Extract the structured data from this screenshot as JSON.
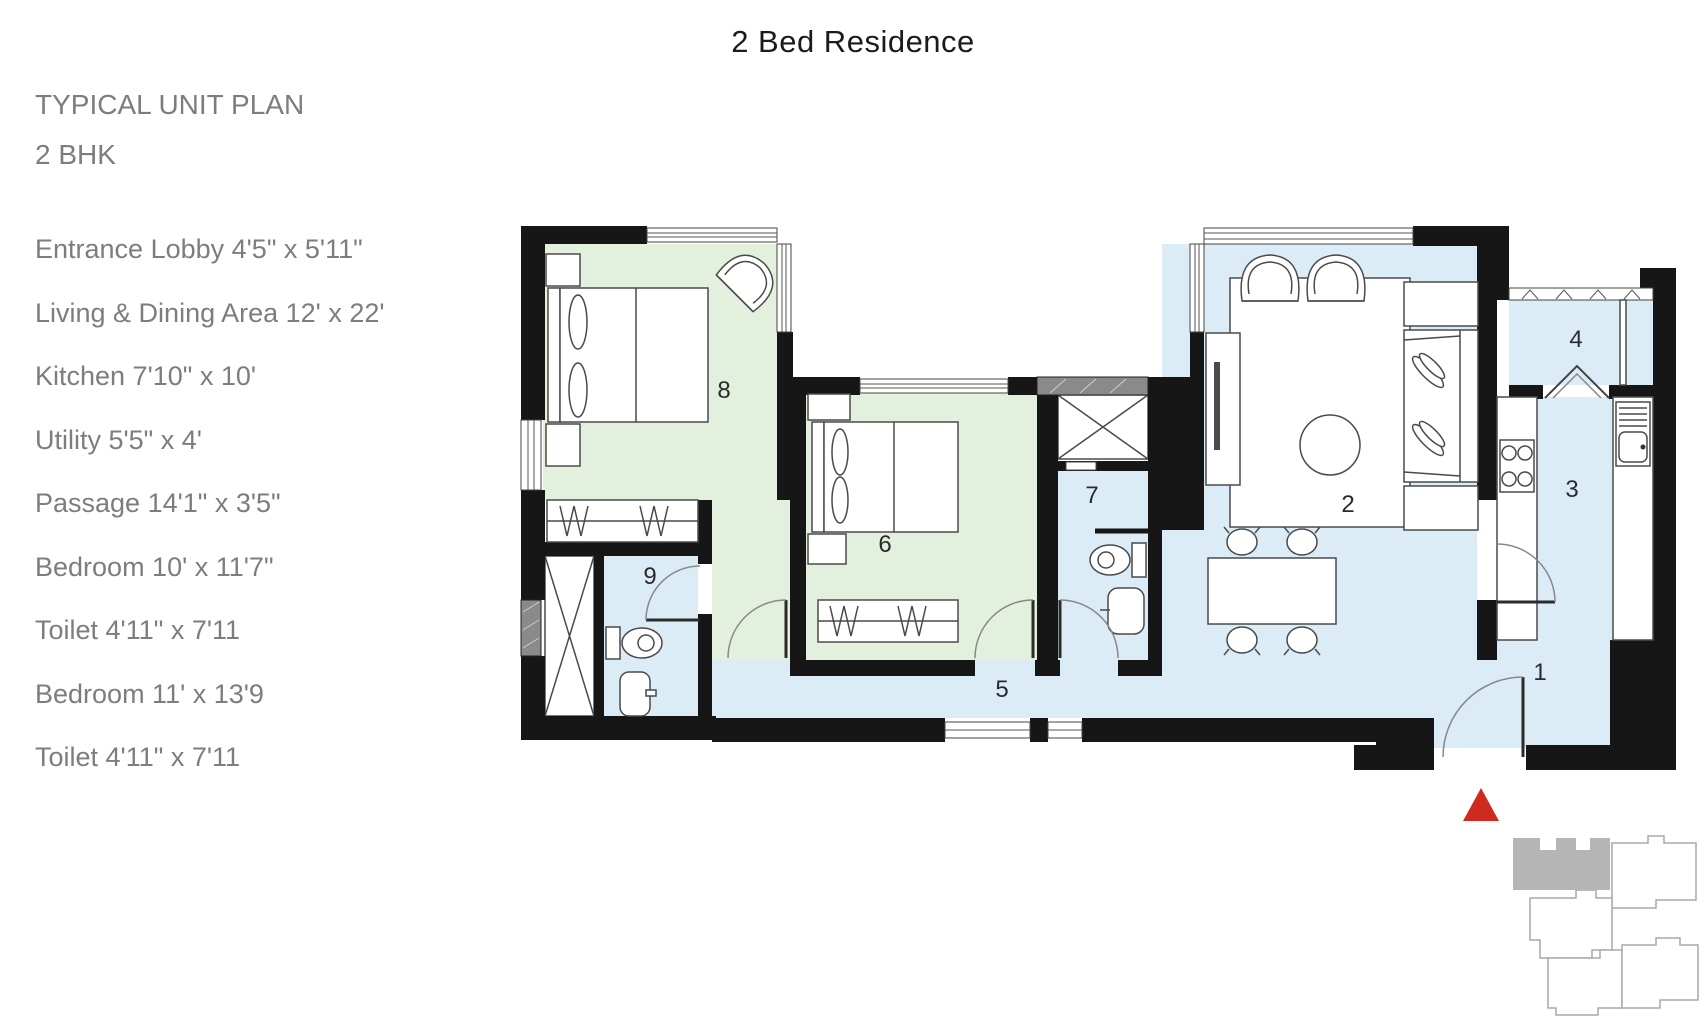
{
  "title": "2 Bed Residence",
  "heading": {
    "line1": "TYPICAL UNIT PLAN",
    "line2": "2 BHK"
  },
  "room_list": [
    "Entrance Lobby 4'5\" x 5'11\"",
    "Living & Dining Area 12' x 22'",
    "Kitchen 7'10\" x 10'",
    "Utility 5'5\" x 4'",
    "Passage 14'1\" x 3'5\"",
    "Bedroom 10' x 11'7\"",
    "Toilet 4'11\" x 7'11",
    "Bedroom 11' x 13'9",
    "Toilet 4'11\" x 7'11"
  ],
  "plan": {
    "room_numbers": {
      "entrance_lobby": "1",
      "living_dining": "2",
      "kitchen": "3",
      "utility": "4",
      "passage": "5",
      "bedroom_2": "6",
      "toilet_2": "7",
      "bedroom_1": "8",
      "toilet_1": "9"
    },
    "colors": {
      "bedroom_fill": "#e4f0de",
      "wet_area_fill": "#dbecf7",
      "wall": "#161616",
      "entry_marker_red": "#ce2a1e",
      "keyplan_unit_gray": "#b5b5b5",
      "label_gray": "#7d7d7d"
    }
  }
}
